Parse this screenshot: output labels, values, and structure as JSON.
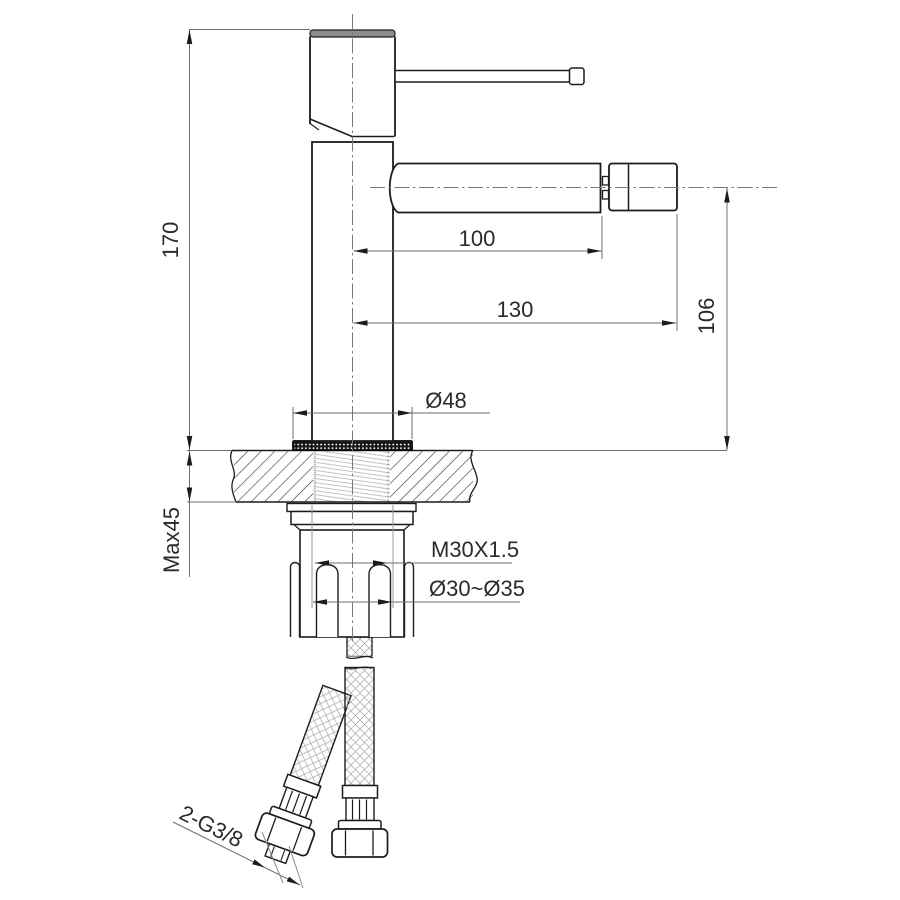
{
  "drawing": {
    "type": "technical-installation-drawing",
    "subject": "single-hole bidet mixer faucet, side elevation with deck mounting section",
    "labels": {
      "overall_height": "170",
      "max_deck_thickness": "Max45",
      "spout_reach": "100",
      "total_reach": "130",
      "spout_height": "106",
      "base_diameter": "Ø48",
      "shank_thread": "M30X1.5",
      "hole_diameter_range": "Ø30~Ø35",
      "hose_thread": "2-G3/8"
    },
    "colors": {
      "object_line": "#1c1c1c",
      "dimension_line": "#6e6e6e",
      "background": "#ffffff",
      "cap_fill": "#8d8d8d",
      "gasket_fill": "#151515"
    }
  }
}
